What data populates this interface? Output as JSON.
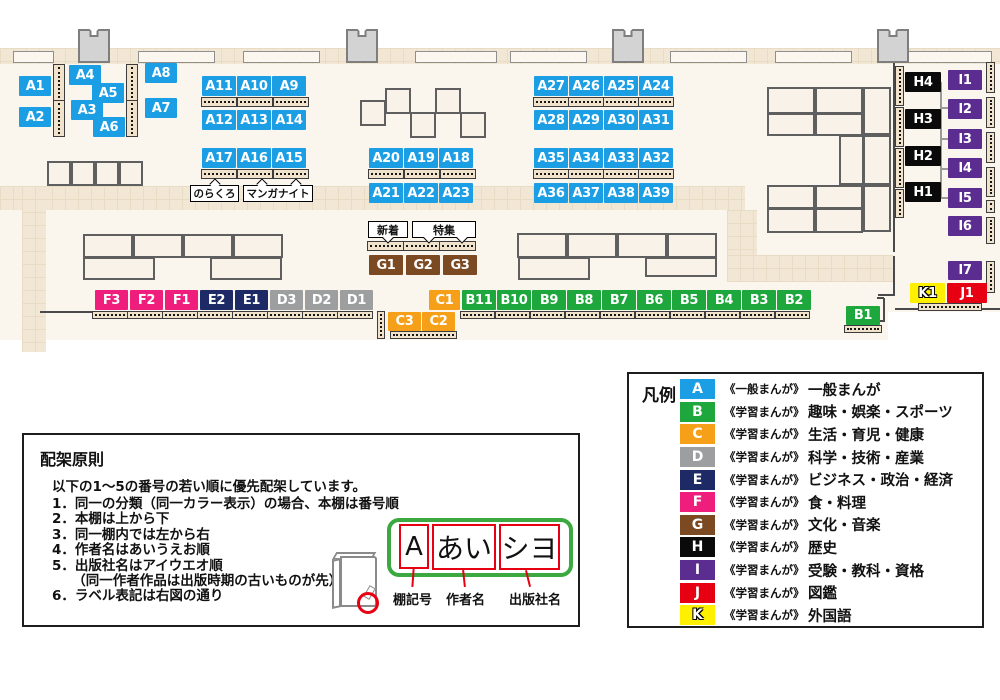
{
  "map": {
    "colors": {
      "A": "#1C9EE4",
      "B": "#1EA73C",
      "C": "#F6A019",
      "D": "#9D9E9F",
      "E": "#1D2A65",
      "F": "#EF1D7B",
      "G": "#7B4A23",
      "H": "#0A0A0A",
      "I": "#5C2D90",
      "J": "#E60012",
      "K": "#FFF000"
    },
    "floor": [
      [
        0,
        62,
        1000,
        250
      ],
      [
        0,
        312,
        888,
        28
      ]
    ],
    "walkways": [
      [
        0,
        48,
        1000,
        16
      ],
      [
        0,
        186,
        745,
        24
      ],
      [
        22,
        186,
        24,
        166
      ],
      [
        727,
        210,
        30,
        48
      ],
      [
        727,
        255,
        166,
        27
      ]
    ],
    "walls": [
      [
        893,
        62,
        2,
        190
      ],
      [
        893,
        256,
        2,
        40
      ],
      [
        878,
        294,
        15,
        2
      ],
      [
        895,
        308,
        105,
        2
      ],
      [
        883,
        298,
        2,
        24
      ],
      [
        877,
        297,
        7,
        2
      ],
      [
        877,
        320,
        7,
        2
      ],
      [
        40,
        311,
        54,
        2
      ]
    ],
    "wall_shelves": [
      [
        13,
        51,
        41,
        12
      ],
      [
        138,
        51,
        77,
        12
      ],
      [
        243,
        51,
        77,
        12
      ],
      [
        415,
        51,
        82,
        12
      ],
      [
        510,
        51,
        77,
        12
      ],
      [
        670,
        51,
        77,
        12
      ],
      [
        775,
        51,
        77,
        12
      ],
      [
        903,
        51,
        89,
        12
      ]
    ],
    "pillars": [
      [
        78,
        29,
        32,
        34
      ],
      [
        346,
        29,
        32,
        34
      ],
      [
        612,
        29,
        32,
        34
      ],
      [
        877,
        29,
        32,
        34
      ]
    ],
    "tables": [
      [
        360,
        100,
        26,
        26
      ],
      [
        385,
        88,
        26,
        26
      ],
      [
        410,
        112,
        26,
        26
      ],
      [
        435,
        88,
        26,
        26
      ],
      [
        460,
        112,
        26,
        26
      ],
      [
        47,
        161,
        24,
        25
      ],
      [
        71,
        161,
        24,
        25
      ],
      [
        95,
        161,
        24,
        25
      ],
      [
        119,
        161,
        24,
        25
      ],
      [
        83,
        234,
        50,
        24
      ],
      [
        133,
        234,
        50,
        24
      ],
      [
        183,
        234,
        50,
        24
      ],
      [
        233,
        234,
        50,
        24
      ],
      [
        83,
        257,
        72,
        23
      ],
      [
        210,
        257,
        72,
        23
      ],
      [
        517,
        233,
        50,
        25
      ],
      [
        567,
        233,
        50,
        25
      ],
      [
        617,
        233,
        50,
        25
      ],
      [
        667,
        233,
        50,
        25
      ],
      [
        518,
        257,
        72,
        23
      ],
      [
        645,
        257,
        72,
        20
      ],
      [
        767,
        87,
        48,
        27
      ],
      [
        815,
        87,
        48,
        27
      ],
      [
        863,
        87,
        28,
        48
      ],
      [
        767,
        113,
        48,
        23
      ],
      [
        815,
        113,
        48,
        23
      ],
      [
        839,
        135,
        25,
        50
      ],
      [
        863,
        135,
        28,
        50
      ],
      [
        767,
        185,
        48,
        24
      ],
      [
        815,
        185,
        48,
        24
      ],
      [
        863,
        185,
        28,
        47
      ],
      [
        767,
        208,
        48,
        25
      ],
      [
        815,
        208,
        48,
        25
      ]
    ],
    "shelves_h": [
      [
        201,
        97,
        36,
        10
      ],
      [
        237,
        97,
        36,
        10
      ],
      [
        273,
        97,
        36,
        10
      ],
      [
        201,
        169,
        36,
        10
      ],
      [
        237,
        169,
        36,
        10
      ],
      [
        273,
        169,
        36,
        10
      ],
      [
        368,
        169,
        36,
        10
      ],
      [
        404,
        169,
        36,
        10
      ],
      [
        440,
        169,
        36,
        10
      ],
      [
        533,
        97,
        36,
        10
      ],
      [
        568,
        97,
        36,
        10
      ],
      [
        603,
        97,
        36,
        10
      ],
      [
        638,
        97,
        36,
        10
      ],
      [
        533,
        169,
        36,
        10
      ],
      [
        568,
        169,
        36,
        10
      ],
      [
        603,
        169,
        36,
        10
      ],
      [
        638,
        169,
        36,
        10
      ],
      [
        367,
        241,
        37,
        10
      ],
      [
        403,
        241,
        37,
        10
      ],
      [
        439,
        241,
        37,
        10
      ],
      [
        92,
        311,
        36,
        8
      ],
      [
        127,
        311,
        36,
        8
      ],
      [
        162,
        311,
        36,
        8
      ],
      [
        197,
        311,
        36,
        8
      ],
      [
        232,
        311,
        36,
        8
      ],
      [
        267,
        311,
        36,
        8
      ],
      [
        302,
        311,
        36,
        8
      ],
      [
        337,
        311,
        36,
        8
      ],
      [
        390,
        331,
        67,
        8
      ],
      [
        460,
        311,
        35,
        8
      ],
      [
        495,
        311,
        35,
        8
      ],
      [
        530,
        311,
        35,
        8
      ],
      [
        565,
        311,
        35,
        8
      ],
      [
        600,
        311,
        35,
        8
      ],
      [
        635,
        311,
        35,
        8
      ],
      [
        670,
        311,
        35,
        8
      ],
      [
        705,
        311,
        35,
        8
      ],
      [
        740,
        311,
        35,
        8
      ],
      [
        775,
        311,
        35,
        8
      ],
      [
        844,
        325,
        38,
        8
      ],
      [
        918,
        303,
        64,
        8
      ]
    ],
    "shelves_v": [
      [
        53,
        64,
        12,
        37
      ],
      [
        53,
        100,
        12,
        37
      ],
      [
        126,
        64,
        12,
        37
      ],
      [
        126,
        100,
        12,
        37
      ],
      [
        377,
        311,
        8,
        28
      ],
      [
        895,
        66,
        9,
        40
      ],
      [
        895,
        107,
        9,
        40
      ],
      [
        895,
        148,
        9,
        40
      ],
      [
        895,
        189,
        9,
        29
      ],
      [
        986,
        62,
        9,
        31
      ],
      [
        986,
        97,
        9,
        31
      ],
      [
        986,
        132,
        9,
        31
      ],
      [
        986,
        167,
        9,
        30
      ],
      [
        986,
        200,
        9,
        13
      ],
      [
        986,
        217,
        9,
        27
      ],
      [
        986,
        261,
        9,
        32
      ]
    ],
    "connectors": [
      [
        940,
        82,
        2,
        117
      ],
      [
        940,
        107,
        9,
        2
      ],
      [
        940,
        138,
        9,
        2
      ],
      [
        940,
        168,
        9,
        2
      ],
      [
        940,
        197,
        9,
        2
      ]
    ],
    "badges": [
      {
        "label": "A1",
        "x": 19,
        "y": 76,
        "w": 32,
        "h": 20
      },
      {
        "label": "A2",
        "x": 19,
        "y": 107,
        "w": 32,
        "h": 20
      },
      {
        "label": "A4",
        "x": 69,
        "y": 65,
        "w": 32,
        "h": 20
      },
      {
        "label": "A5",
        "x": 92,
        "y": 83,
        "w": 32,
        "h": 20
      },
      {
        "label": "A3",
        "x": 71,
        "y": 100,
        "w": 32,
        "h": 20
      },
      {
        "label": "A6",
        "x": 93,
        "y": 117,
        "w": 32,
        "h": 20
      },
      {
        "label": "A8",
        "x": 145,
        "y": 63,
        "w": 32,
        "h": 20
      },
      {
        "label": "A7",
        "x": 145,
        "y": 98,
        "w": 32,
        "h": 20
      },
      {
        "label": "A11",
        "x": 202,
        "y": 76,
        "w": 34,
        "h": 20
      },
      {
        "label": "A10",
        "x": 237,
        "y": 76,
        "w": 34,
        "h": 20
      },
      {
        "label": "A9",
        "x": 272,
        "y": 76,
        "w": 34,
        "h": 20
      },
      {
        "label": "A12",
        "x": 202,
        "y": 110,
        "w": 34,
        "h": 20
      },
      {
        "label": "A13",
        "x": 237,
        "y": 110,
        "w": 34,
        "h": 20
      },
      {
        "label": "A14",
        "x": 272,
        "y": 110,
        "w": 34,
        "h": 20
      },
      {
        "label": "A17",
        "x": 202,
        "y": 148,
        "w": 34,
        "h": 20
      },
      {
        "label": "A16",
        "x": 237,
        "y": 148,
        "w": 34,
        "h": 20
      },
      {
        "label": "A15",
        "x": 272,
        "y": 148,
        "w": 34,
        "h": 20
      },
      {
        "label": "A20",
        "x": 369,
        "y": 148,
        "w": 34,
        "h": 20
      },
      {
        "label": "A19",
        "x": 404,
        "y": 148,
        "w": 34,
        "h": 20
      },
      {
        "label": "A18",
        "x": 439,
        "y": 148,
        "w": 34,
        "h": 20
      },
      {
        "label": "A21",
        "x": 369,
        "y": 183,
        "w": 34,
        "h": 20
      },
      {
        "label": "A22",
        "x": 404,
        "y": 183,
        "w": 34,
        "h": 20
      },
      {
        "label": "A23",
        "x": 439,
        "y": 183,
        "w": 34,
        "h": 20
      },
      {
        "label": "A27",
        "x": 534,
        "y": 76,
        "w": 34,
        "h": 20
      },
      {
        "label": "A26",
        "x": 569,
        "y": 76,
        "w": 34,
        "h": 20
      },
      {
        "label": "A25",
        "x": 604,
        "y": 76,
        "w": 34,
        "h": 20
      },
      {
        "label": "A24",
        "x": 639,
        "y": 76,
        "w": 34,
        "h": 20
      },
      {
        "label": "A28",
        "x": 534,
        "y": 110,
        "w": 34,
        "h": 20
      },
      {
        "label": "A29",
        "x": 569,
        "y": 110,
        "w": 34,
        "h": 20
      },
      {
        "label": "A30",
        "x": 604,
        "y": 110,
        "w": 34,
        "h": 20
      },
      {
        "label": "A31",
        "x": 639,
        "y": 110,
        "w": 34,
        "h": 20
      },
      {
        "label": "A35",
        "x": 534,
        "y": 148,
        "w": 34,
        "h": 20
      },
      {
        "label": "A34",
        "x": 569,
        "y": 148,
        "w": 34,
        "h": 20
      },
      {
        "label": "A33",
        "x": 604,
        "y": 148,
        "w": 34,
        "h": 20
      },
      {
        "label": "A32",
        "x": 639,
        "y": 148,
        "w": 34,
        "h": 20
      },
      {
        "label": "A36",
        "x": 534,
        "y": 183,
        "w": 34,
        "h": 20
      },
      {
        "label": "A37",
        "x": 569,
        "y": 183,
        "w": 34,
        "h": 20
      },
      {
        "label": "A38",
        "x": 604,
        "y": 183,
        "w": 34,
        "h": 20
      },
      {
        "label": "A39",
        "x": 639,
        "y": 183,
        "w": 34,
        "h": 20
      },
      {
        "label": "G1",
        "x": 369,
        "y": 255,
        "w": 34,
        "h": 20
      },
      {
        "label": "G2",
        "x": 406,
        "y": 255,
        "w": 34,
        "h": 20
      },
      {
        "label": "G3",
        "x": 443,
        "y": 255,
        "w": 34,
        "h": 20
      },
      {
        "label": "F3",
        "x": 95,
        "y": 290,
        "w": 33,
        "h": 20
      },
      {
        "label": "F2",
        "x": 130,
        "y": 290,
        "w": 33,
        "h": 20
      },
      {
        "label": "F1",
        "x": 165,
        "y": 290,
        "w": 33,
        "h": 20
      },
      {
        "label": "E2",
        "x": 200,
        "y": 290,
        "w": 33,
        "h": 20
      },
      {
        "label": "E1",
        "x": 235,
        "y": 290,
        "w": 33,
        "h": 20
      },
      {
        "label": "D3",
        "x": 270,
        "y": 290,
        "w": 33,
        "h": 20
      },
      {
        "label": "D2",
        "x": 305,
        "y": 290,
        "w": 33,
        "h": 20
      },
      {
        "label": "D1",
        "x": 340,
        "y": 290,
        "w": 33,
        "h": 20
      },
      {
        "label": "C1",
        "x": 429,
        "y": 290,
        "w": 31,
        "h": 20
      },
      {
        "label": "C3",
        "x": 388,
        "y": 312,
        "w": 33,
        "h": 19
      },
      {
        "label": "C2",
        "x": 422,
        "y": 312,
        "w": 33,
        "h": 19
      },
      {
        "label": "B11",
        "x": 462,
        "y": 290,
        "w": 34,
        "h": 20
      },
      {
        "label": "B10",
        "x": 497,
        "y": 290,
        "w": 34,
        "h": 20
      },
      {
        "label": "B9",
        "x": 532,
        "y": 290,
        "w": 34,
        "h": 20
      },
      {
        "label": "B8",
        "x": 567,
        "y": 290,
        "w": 34,
        "h": 20
      },
      {
        "label": "B7",
        "x": 602,
        "y": 290,
        "w": 34,
        "h": 20
      },
      {
        "label": "B6",
        "x": 637,
        "y": 290,
        "w": 34,
        "h": 20
      },
      {
        "label": "B5",
        "x": 672,
        "y": 290,
        "w": 34,
        "h": 20
      },
      {
        "label": "B4",
        "x": 707,
        "y": 290,
        "w": 34,
        "h": 20
      },
      {
        "label": "B3",
        "x": 742,
        "y": 290,
        "w": 34,
        "h": 20
      },
      {
        "label": "B2",
        "x": 777,
        "y": 290,
        "w": 34,
        "h": 20
      },
      {
        "label": "B1",
        "x": 846,
        "y": 306,
        "w": 34,
        "h": 19
      },
      {
        "label": "K1",
        "x": 910,
        "y": 283,
        "w": 35,
        "h": 20
      },
      {
        "label": "J1",
        "x": 947,
        "y": 283,
        "w": 40,
        "h": 20
      },
      {
        "label": "H4",
        "x": 905,
        "y": 72,
        "w": 36,
        "h": 20
      },
      {
        "label": "H3",
        "x": 905,
        "y": 109,
        "w": 36,
        "h": 20
      },
      {
        "label": "H2",
        "x": 905,
        "y": 146,
        "w": 36,
        "h": 20
      },
      {
        "label": "H1",
        "x": 905,
        "y": 182,
        "w": 36,
        "h": 20
      },
      {
        "label": "I1",
        "x": 948,
        "y": 70,
        "w": 34,
        "h": 20
      },
      {
        "label": "I2",
        "x": 948,
        "y": 99,
        "w": 34,
        "h": 20
      },
      {
        "label": "I3",
        "x": 948,
        "y": 129,
        "w": 34,
        "h": 20
      },
      {
        "label": "I4",
        "x": 948,
        "y": 158,
        "w": 34,
        "h": 20
      },
      {
        "label": "I5",
        "x": 948,
        "y": 188,
        "w": 34,
        "h": 20
      },
      {
        "label": "I6",
        "x": 948,
        "y": 216,
        "w": 34,
        "h": 20
      },
      {
        "label": "I7",
        "x": 948,
        "y": 261,
        "w": 34,
        "h": 19
      }
    ],
    "shelf_labels": [
      {
        "text": "のらくろ",
        "x": 190,
        "y": 185,
        "w": 49,
        "h": 17,
        "fs": 10.5
      },
      {
        "text": "マンガナイト",
        "x": 243,
        "y": 185,
        "w": 70,
        "h": 17,
        "fs": 10.5
      },
      {
        "text": "新着",
        "x": 368,
        "y": 221,
        "w": 40,
        "h": 17,
        "fs": 11
      },
      {
        "text": "特集",
        "x": 412,
        "y": 221,
        "w": 64,
        "h": 17,
        "fs": 11
      }
    ],
    "carets": [
      {
        "dir": "up",
        "x": 211,
        "y": 180
      },
      {
        "dir": "up",
        "x": 258,
        "y": 180
      },
      {
        "dir": "up",
        "x": 292,
        "y": 180
      },
      {
        "dir": "down",
        "x": 384,
        "y": 234
      },
      {
        "dir": "down",
        "x": 425,
        "y": 234
      },
      {
        "dir": "down",
        "x": 458,
        "y": 234
      }
    ]
  },
  "legend": {
    "title": "凡例",
    "rows": [
      {
        "letter": "A",
        "type": "《一般まんが》",
        "category": "一般まんが"
      },
      {
        "letter": "B",
        "type": "《学習まんが》",
        "category": "趣味・娯楽・スポーツ"
      },
      {
        "letter": "C",
        "type": "《学習まんが》",
        "category": "生活・育児・健康"
      },
      {
        "letter": "D",
        "type": "《学習まんが》",
        "category": "科学・技術・産業"
      },
      {
        "letter": "E",
        "type": "《学習まんが》",
        "category": "ビジネス・政治・経済"
      },
      {
        "letter": "F",
        "type": "《学習まんが》",
        "category": "食・料理"
      },
      {
        "letter": "G",
        "type": "《学習まんが》",
        "category": "文化・音楽"
      },
      {
        "letter": "H",
        "type": "《学習まんが》",
        "category": "歴史"
      },
      {
        "letter": "I",
        "type": "《学習まんが》",
        "category": "受験・教科・資格"
      },
      {
        "letter": "J",
        "type": "《学習まんが》",
        "category": "図鑑"
      },
      {
        "letter": "K",
        "type": "《学習まんが》",
        "category": "外国語"
      }
    ]
  },
  "principles": {
    "title": "配架原則",
    "intro": "以下の1～5の番号の若い順に優先配架しています。",
    "items": [
      "1．同一の分類（同一カラー表示）の場合、本棚は番号順",
      "2．本棚は上から下",
      "3．同一棚内では左から右",
      "4．作者名はあいうえお順",
      "5．出版社名はアイウエオ順",
      "　　（同一作者作品は出版時期の古いものが先）",
      "6．ラベル表記は右図の通り"
    ],
    "label_example": {
      "cells": [
        "A",
        "あい",
        "シヨ"
      ],
      "pointer_labels": [
        "棚記号",
        "作者名",
        "出版社名"
      ],
      "frame_color": "#3BA93F",
      "cell_border_color": "#E60012"
    }
  }
}
